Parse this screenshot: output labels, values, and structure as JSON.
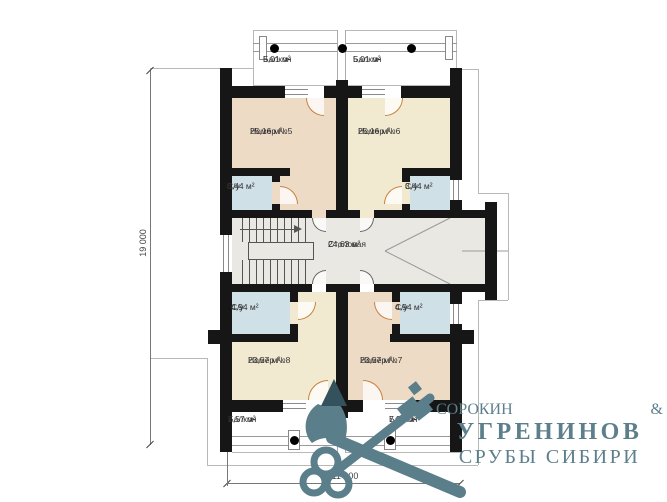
{
  "plan": {
    "rooms": [
      {
        "id": "balcony-top-left",
        "name": "Балкон",
        "area": "5,01 м²"
      },
      {
        "id": "balcony-top-right",
        "name": "Балкон",
        "area": "5,01 м²"
      },
      {
        "id": "room-5",
        "name": "Номер №5",
        "area": "25,16 м²"
      },
      {
        "id": "room-6",
        "name": "Номер №6",
        "area": "25,16 м²"
      },
      {
        "id": "bathroom-room5",
        "name": "С/у",
        "area": "3,44 м²"
      },
      {
        "id": "bathroom-room6",
        "name": "С/у",
        "area": "3,44 м²"
      },
      {
        "id": "dining-room",
        "name": "Столовая",
        "area": "24,63 м²"
      },
      {
        "id": "bathroom-room8",
        "name": "С/у",
        "area": "4,94 м²"
      },
      {
        "id": "bathroom-room7",
        "name": "С/у",
        "area": "4,94 м²"
      },
      {
        "id": "room-8",
        "name": "Номер №8",
        "area": "23,57 м²"
      },
      {
        "id": "room-7",
        "name": "Номер №7",
        "area": "23,57 м²"
      },
      {
        "id": "balcony-bottom-left",
        "name": "Балкон",
        "area": "7,57 м²"
      },
      {
        "id": "balcony-bottom-right",
        "name": "Балкон",
        "area": "7,57 м²"
      }
    ],
    "dimensions": {
      "height": "19 000",
      "width": "11 000"
    },
    "colors": {
      "room_warm": "#eedbc6",
      "room_cream": "#f1ead0",
      "bathroom": "#cfe0e7",
      "hall": "#e9e8e3",
      "wall": "#161616",
      "door_arc": "#c97f3f"
    }
  },
  "logo": {
    "name1": "СОРОКИН",
    "amp": "&",
    "name2": "УГРЕНИНОВ",
    "tagline": "СРУБЫ СИБИРИ",
    "color": "#5d7f8b",
    "icon": "crossed-axes-and-key-icon"
  }
}
